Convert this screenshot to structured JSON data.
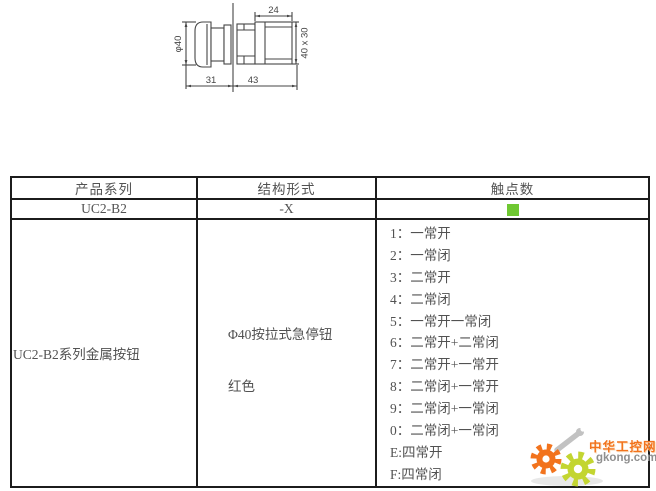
{
  "drawing": {
    "dim_diameter": "φ40",
    "dim_top_width": "24",
    "dim_side": "40 x 30",
    "dim_head_depth": "31",
    "dim_body_depth": "43"
  },
  "table": {
    "headers": [
      "产品系列",
      "结构形式",
      "触点数"
    ],
    "model_row": {
      "series": "UC2-B2",
      "structure": "-X"
    },
    "contact_marker_color": "#6fc832",
    "detail": {
      "series_desc": "UC2-B2系列金属按钮",
      "structure_desc": "Φ40按拉式急停钮",
      "color_desc": "红色",
      "contacts": [
        "1：一常开",
        "2：一常闭",
        "3：二常开",
        "4：二常闭",
        "5：一常开一常闭",
        "6：二常开+二常闭",
        "7：二常开+一常开",
        "8：二常闭+一常开",
        "9：二常闭+一常闭",
        "0：二常闭+一常闭",
        "E:四常开",
        "F:四常闭"
      ]
    }
  },
  "watermark": {
    "site_name": "中华工控网",
    "site_url": "gkong.com",
    "orange": "#f2731d",
    "green": "#c3d531",
    "gray": "#8f8f8f"
  }
}
